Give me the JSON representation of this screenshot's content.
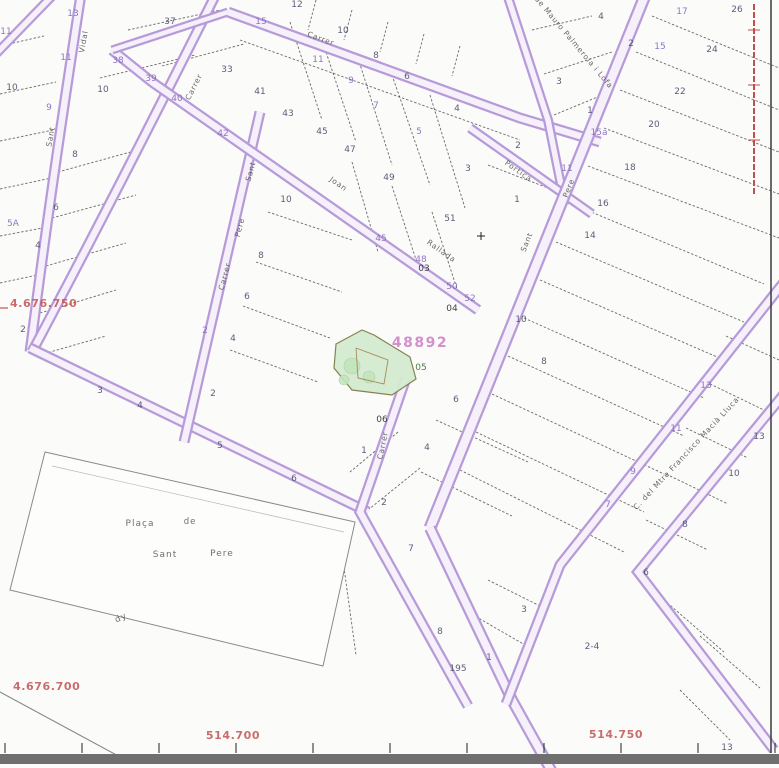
{
  "map": {
    "title": "cadastral-parcel-map",
    "background": "#fbfbfa",
    "colors": {
      "street_edge": "#b79bd8",
      "street_fill": "#f5f0fa",
      "parcel_line": "#3c3c3c",
      "number_blue": "#4c4c6e",
      "number_purple": "#8668c0",
      "number_black": "#2e2e2e",
      "number_green": "#3a6b35",
      "parcel_code_pink": "#cc74c4",
      "coord_red": "#c05553",
      "street_name_gray": "#4d4d4d",
      "highlight_fill": "#d5ecd0",
      "highlight_stroke": "#7d7d49",
      "tree_fill": "#c4e5bd",
      "building_line": "#a08050",
      "bottom_bar": "#6f6f6f",
      "border_line": "#3a3a3a",
      "boundary_red": "#c24f4c",
      "plaza_outline": "#8a8a8a"
    },
    "highlight": {
      "code": "48892",
      "code_pos": {
        "x": 420,
        "y": 347
      },
      "polygon": "336,344 362,330 374,335 410,357 416,379 392,395 352,390 334,368",
      "trees": [
        {
          "cx": 352,
          "cy": 366,
          "r": 8
        },
        {
          "cx": 369,
          "cy": 377,
          "r": 6
        },
        {
          "cx": 344,
          "cy": 380,
          "r": 5
        }
      ],
      "building": "356,348 388,360 384,384 358,378 356,348"
    },
    "coords": {
      "left": [
        {
          "t": "4.676.750",
          "x": 10,
          "y": 307
        },
        {
          "t": "4.676.700",
          "x": 13,
          "y": 690
        }
      ],
      "bottom": [
        {
          "t": "514.700",
          "x": 233,
          "y": 739
        },
        {
          "t": "514.750",
          "x": 616,
          "y": 738
        }
      ]
    },
    "street_names": [
      {
        "t": "Vidal",
        "x": 86,
        "y": 42,
        "r": -80
      },
      {
        "t": "Sant",
        "x": 53,
        "y": 137,
        "r": -80
      },
      {
        "t": "Carrer",
        "x": 196,
        "y": 88,
        "r": -63
      },
      {
        "t": "Carrer",
        "x": 320,
        "y": 41,
        "r": 20
      },
      {
        "t": "Joan",
        "x": 337,
        "y": 186,
        "r": 35
      },
      {
        "t": "Rallada",
        "x": 440,
        "y": 253,
        "r": 35
      },
      {
        "t": "Sant",
        "x": 253,
        "y": 172,
        "r": -75
      },
      {
        "t": "Pere",
        "x": 242,
        "y": 228,
        "r": -75
      },
      {
        "t": "Carrer",
        "x": 227,
        "y": 277,
        "r": -75
      },
      {
        "t": "Carrer",
        "x": 385,
        "y": 446,
        "r": -78
      },
      {
        "t": "Pere",
        "x": 571,
        "y": 189,
        "r": -68
      },
      {
        "t": "Sant",
        "x": 529,
        "y": 243,
        "r": -68
      },
      {
        "t": "Portica",
        "x": 517,
        "y": 173,
        "r": 35
      },
      {
        "t": "de Mauro Palmerola i Lofa",
        "x": 572,
        "y": 44,
        "r": 50
      },
      {
        "t": "C. del Mtre Francisco Macià Lluca",
        "x": 688,
        "y": 455,
        "r": -47
      }
    ],
    "place_labels": [
      {
        "t": "Plaça",
        "x": 140,
        "y": 526,
        "r": 0
      },
      {
        "t": "de",
        "x": 190,
        "y": 524,
        "r": 0
      },
      {
        "t": "Sant",
        "x": 165,
        "y": 557,
        "r": 0
      },
      {
        "t": "Pere",
        "x": 222,
        "y": 556,
        "r": 0
      },
      {
        "t": "dy",
        "x": 122,
        "y": 620,
        "r": -25
      }
    ],
    "numbers": [
      {
        "t": "13",
        "x": 73,
        "y": 16,
        "k": "p"
      },
      {
        "t": "11",
        "x": 66,
        "y": 60,
        "k": "p"
      },
      {
        "t": "38",
        "x": 118,
        "y": 63,
        "k": "p"
      },
      {
        "t": "39",
        "x": 151,
        "y": 81,
        "k": "p"
      },
      {
        "t": "40",
        "x": 177,
        "y": 101,
        "k": "p"
      },
      {
        "t": "42",
        "x": 223,
        "y": 136,
        "k": "p"
      },
      {
        "t": "15",
        "x": 261,
        "y": 24,
        "k": "p"
      },
      {
        "t": "11",
        "x": 318,
        "y": 62,
        "k": "p"
      },
      {
        "t": "9",
        "x": 351,
        "y": 83,
        "k": "p"
      },
      {
        "t": "7",
        "x": 376,
        "y": 108,
        "k": "p"
      },
      {
        "t": "5",
        "x": 419,
        "y": 134,
        "k": "p"
      },
      {
        "t": "45",
        "x": 381,
        "y": 241,
        "k": "p"
      },
      {
        "t": "48",
        "x": 421,
        "y": 262,
        "k": "p"
      },
      {
        "t": "50",
        "x": 452,
        "y": 289,
        "k": "p"
      },
      {
        "t": "52",
        "x": 470,
        "y": 301,
        "k": "p"
      },
      {
        "t": "17",
        "x": 682,
        "y": 14,
        "k": "p"
      },
      {
        "t": "15",
        "x": 660,
        "y": 49,
        "k": "p"
      },
      {
        "t": "15a",
        "x": 599,
        "y": 135,
        "k": "p"
      },
      {
        "t": "11",
        "x": 567,
        "y": 171,
        "k": "p"
      },
      {
        "t": "13",
        "x": 706,
        "y": 388,
        "k": "p"
      },
      {
        "t": "11",
        "x": 676,
        "y": 431,
        "k": "p"
      },
      {
        "t": "9",
        "x": 633,
        "y": 474,
        "k": "p"
      },
      {
        "t": "7",
        "x": 608,
        "y": 507,
        "k": "p"
      },
      {
        "t": "9",
        "x": 49,
        "y": 110,
        "k": "p"
      },
      {
        "t": "5A",
        "x": 13,
        "y": 226,
        "k": "p"
      },
      {
        "t": "2",
        "x": 205,
        "y": 333,
        "k": "p"
      },
      {
        "t": "11",
        "x": 6,
        "y": 34,
        "k": "p"
      },
      {
        "t": "37",
        "x": 170,
        "y": 24,
        "k": "b"
      },
      {
        "t": "10",
        "x": 103,
        "y": 92,
        "k": "b"
      },
      {
        "t": "33",
        "x": 227,
        "y": 72,
        "k": "b"
      },
      {
        "t": "41",
        "x": 260,
        "y": 94,
        "k": "b"
      },
      {
        "t": "43",
        "x": 288,
        "y": 116,
        "k": "b"
      },
      {
        "t": "45",
        "x": 322,
        "y": 134,
        "k": "b"
      },
      {
        "t": "47",
        "x": 350,
        "y": 152,
        "k": "b"
      },
      {
        "t": "49",
        "x": 389,
        "y": 180,
        "k": "b"
      },
      {
        "t": "51",
        "x": 450,
        "y": 221,
        "k": "b"
      },
      {
        "t": "12",
        "x": 297,
        "y": 7,
        "k": "b"
      },
      {
        "t": "10",
        "x": 343,
        "y": 33,
        "k": "b"
      },
      {
        "t": "8",
        "x": 376,
        "y": 58,
        "k": "b"
      },
      {
        "t": "6",
        "x": 407,
        "y": 79,
        "k": "b"
      },
      {
        "t": "4",
        "x": 457,
        "y": 111,
        "k": "b"
      },
      {
        "t": "3",
        "x": 468,
        "y": 171,
        "k": "b"
      },
      {
        "t": "4",
        "x": 601,
        "y": 19,
        "k": "b"
      },
      {
        "t": "2",
        "x": 631,
        "y": 46,
        "k": "b"
      },
      {
        "t": "3",
        "x": 559,
        "y": 84,
        "k": "b"
      },
      {
        "t": "1",
        "x": 590,
        "y": 113,
        "k": "b"
      },
      {
        "t": "2",
        "x": 518,
        "y": 148,
        "k": "b"
      },
      {
        "t": "1",
        "x": 517,
        "y": 202,
        "k": "b"
      },
      {
        "t": "24",
        "x": 712,
        "y": 52,
        "k": "b"
      },
      {
        "t": "26",
        "x": 737,
        "y": 12,
        "k": "b"
      },
      {
        "t": "22",
        "x": 680,
        "y": 94,
        "k": "b"
      },
      {
        "t": "20",
        "x": 654,
        "y": 127,
        "k": "b"
      },
      {
        "t": "18",
        "x": 630,
        "y": 170,
        "k": "b"
      },
      {
        "t": "16",
        "x": 603,
        "y": 206,
        "k": "b"
      },
      {
        "t": "14",
        "x": 590,
        "y": 238,
        "k": "b"
      },
      {
        "t": "10",
        "x": 521,
        "y": 322,
        "k": "b"
      },
      {
        "t": "8",
        "x": 544,
        "y": 364,
        "k": "b"
      },
      {
        "t": "6",
        "x": 456,
        "y": 402,
        "k": "b"
      },
      {
        "t": "10",
        "x": 734,
        "y": 476,
        "k": "b"
      },
      {
        "t": "13",
        "x": 759,
        "y": 439,
        "k": "b"
      },
      {
        "t": "8",
        "x": 685,
        "y": 527,
        "k": "b"
      },
      {
        "t": "6",
        "x": 646,
        "y": 575,
        "k": "b"
      },
      {
        "t": "6",
        "x": 56,
        "y": 210,
        "k": "b"
      },
      {
        "t": "4",
        "x": 38,
        "y": 248,
        "k": "b"
      },
      {
        "t": "2",
        "x": 23,
        "y": 332,
        "k": "b"
      },
      {
        "t": "3",
        "x": 100,
        "y": 393,
        "k": "b"
      },
      {
        "t": "4",
        "x": 140,
        "y": 408,
        "k": "b"
      },
      {
        "t": "8",
        "x": 75,
        "y": 157,
        "k": "b"
      },
      {
        "t": "10",
        "x": 12,
        "y": 90,
        "k": "b"
      },
      {
        "t": "10",
        "x": 286,
        "y": 202,
        "k": "b"
      },
      {
        "t": "8",
        "x": 261,
        "y": 258,
        "k": "b"
      },
      {
        "t": "6",
        "x": 247,
        "y": 299,
        "k": "b"
      },
      {
        "t": "4",
        "x": 233,
        "y": 341,
        "k": "b"
      },
      {
        "t": "2",
        "x": 213,
        "y": 396,
        "k": "b"
      },
      {
        "t": "5",
        "x": 220,
        "y": 448,
        "k": "b"
      },
      {
        "t": "6",
        "x": 294,
        "y": 481,
        "k": "b"
      },
      {
        "t": "1",
        "x": 364,
        "y": 453,
        "k": "b"
      },
      {
        "t": "4",
        "x": 427,
        "y": 450,
        "k": "b"
      },
      {
        "t": "2",
        "x": 384,
        "y": 505,
        "k": "b"
      },
      {
        "t": "7",
        "x": 411,
        "y": 551,
        "k": "b"
      },
      {
        "t": "8",
        "x": 440,
        "y": 634,
        "k": "b"
      },
      {
        "t": "195",
        "x": 458,
        "y": 671,
        "k": "b"
      },
      {
        "t": "1",
        "x": 489,
        "y": 660,
        "k": "b"
      },
      {
        "t": "3",
        "x": 524,
        "y": 612,
        "k": "b"
      },
      {
        "t": "2-4",
        "x": 592,
        "y": 649,
        "k": "b"
      },
      {
        "t": "13",
        "x": 727,
        "y": 750,
        "k": "b"
      },
      {
        "t": "03",
        "x": 424,
        "y": 271,
        "k": "k"
      },
      {
        "t": "04",
        "x": 452,
        "y": 311,
        "k": "k"
      },
      {
        "t": "06",
        "x": 382,
        "y": 422,
        "k": "k"
      },
      {
        "t": "05",
        "x": 421,
        "y": 370,
        "k": "g"
      }
    ],
    "streets": [
      {
        "d": "M 56,-8 L -8,58",
        "w": 10
      },
      {
        "d": "M 82,-12 Q 52,180 30,352",
        "w": 11
      },
      {
        "d": "M 218,-10 Q 118,190 32,352",
        "w": 11
      },
      {
        "d": "M 30,348 L 368,512",
        "w": 11
      },
      {
        "d": "M 260,112 L 184,442",
        "w": 11
      },
      {
        "d": "M 112,50 L 152,82 L 478,310",
        "w": 11
      },
      {
        "d": "M 112,50 L 228,12",
        "w": 9
      },
      {
        "d": "M 228,12 L 520,118 L 600,142",
        "w": 11
      },
      {
        "d": "M 505,-12 L 548,120 L 565,205",
        "w": 10
      },
      {
        "d": "M 470,128 L 592,214",
        "w": 10
      },
      {
        "d": "M 648,-12 L 430,528",
        "w": 13
      },
      {
        "d": "M 406,378 L 360,512 L 468,706",
        "w": 11
      },
      {
        "d": "M 430,528 L 512,700 L 552,772",
        "w": 12
      },
      {
        "d": "M 784,282 L 560,565 L 506,704",
        "w": 11
      },
      {
        "d": "M 784,394 L 638,572 L 774,750",
        "w": 11
      }
    ],
    "parcel_lines": [
      [
        0,
        46,
        44,
        36
      ],
      [
        0,
        94,
        56,
        82
      ],
      [
        0,
        141,
        58,
        129
      ],
      [
        0,
        189,
        56,
        177
      ],
      [
        0,
        236,
        48,
        227
      ],
      [
        0,
        283,
        42,
        274
      ],
      [
        58,
        172,
        145,
        148
      ],
      [
        52,
        218,
        136,
        195
      ],
      [
        46,
        266,
        126,
        243
      ],
      [
        40,
        313,
        116,
        290
      ],
      [
        36,
        356,
        106,
        336
      ],
      [
        128,
        30,
        220,
        10
      ],
      [
        100,
        78,
        195,
        55
      ],
      [
        162,
        66,
        244,
        44
      ],
      [
        290,
        22,
        322,
        120
      ],
      [
        322,
        40,
        356,
        142
      ],
      [
        358,
        58,
        392,
        165
      ],
      [
        392,
        75,
        430,
        185
      ],
      [
        430,
        95,
        465,
        208
      ],
      [
        240,
        40,
        520,
        140
      ],
      [
        316,
        0,
        308,
        30
      ],
      [
        352,
        10,
        344,
        40
      ],
      [
        388,
        22,
        380,
        52
      ],
      [
        424,
        34,
        416,
        64
      ],
      [
        460,
        46,
        452,
        76
      ],
      [
        268,
        212,
        352,
        240
      ],
      [
        256,
        262,
        342,
        292
      ],
      [
        243,
        306,
        330,
        338
      ],
      [
        230,
        350,
        318,
        382
      ],
      [
        352,
        162,
        378,
        252
      ],
      [
        392,
        186,
        420,
        272
      ],
      [
        432,
        212,
        458,
        292
      ],
      [
        398,
        432,
        350,
        472
      ],
      [
        420,
        468,
        368,
        510
      ],
      [
        436,
        420,
        528,
        462
      ],
      [
        421,
        472,
        512,
        516
      ],
      [
        468,
        612,
        525,
        645
      ],
      [
        488,
        580,
        540,
        606
      ],
      [
        652,
        16,
        779,
        68
      ],
      [
        636,
        52,
        779,
        110
      ],
      [
        620,
        90,
        779,
        152
      ],
      [
        604,
        128,
        779,
        194
      ],
      [
        588,
        166,
        779,
        238
      ],
      [
        572,
        204,
        764,
        284
      ],
      [
        556,
        242,
        744,
        322
      ],
      [
        540,
        280,
        724,
        360
      ],
      [
        524,
        318,
        704,
        398
      ],
      [
        508,
        356,
        684,
        436
      ],
      [
        492,
        394,
        664,
        474
      ],
      [
        476,
        432,
        644,
        512
      ],
      [
        460,
        470,
        624,
        552
      ],
      [
        726,
        336,
        779,
        360
      ],
      [
        706,
        382,
        768,
        412
      ],
      [
        686,
        428,
        748,
        458
      ],
      [
        666,
        474,
        728,
        504
      ],
      [
        646,
        520,
        708,
        550
      ],
      [
        700,
        636,
        760,
        688
      ],
      [
        664,
        600,
        724,
        652
      ],
      [
        680,
        690,
        730,
        740
      ],
      [
        532,
        30,
        592,
        16
      ],
      [
        544,
        74,
        612,
        52
      ],
      [
        554,
        115,
        600,
        96
      ],
      [
        488,
        165,
        548,
        188
      ],
      [
        338,
        524,
        356,
        655
      ]
    ],
    "plaza": {
      "outline": "45,452 355,522 323,666 10,590",
      "inner_line": [
        52,
        466,
        344,
        532
      ]
    },
    "misc": {
      "bottom_diagonal": [
        0,
        692,
        122,
        758
      ],
      "right_border_x": 771,
      "red_boundary": {
        "x": 754,
        "y1": 4,
        "y2": 196,
        "ticks": [
          30,
          85,
          140
        ]
      },
      "red_left_tick": [
        0,
        308,
        8,
        308
      ],
      "grid_cross": {
        "x": 481,
        "y": 236
      },
      "bottom_ticks_x": [
        5,
        82,
        159,
        236,
        313,
        390,
        467,
        544,
        621,
        698,
        775
      ],
      "bottom_ticks_y": [
        743,
        753
      ],
      "bottom_bar": {
        "y": 754,
        "h": 10
      }
    }
  }
}
